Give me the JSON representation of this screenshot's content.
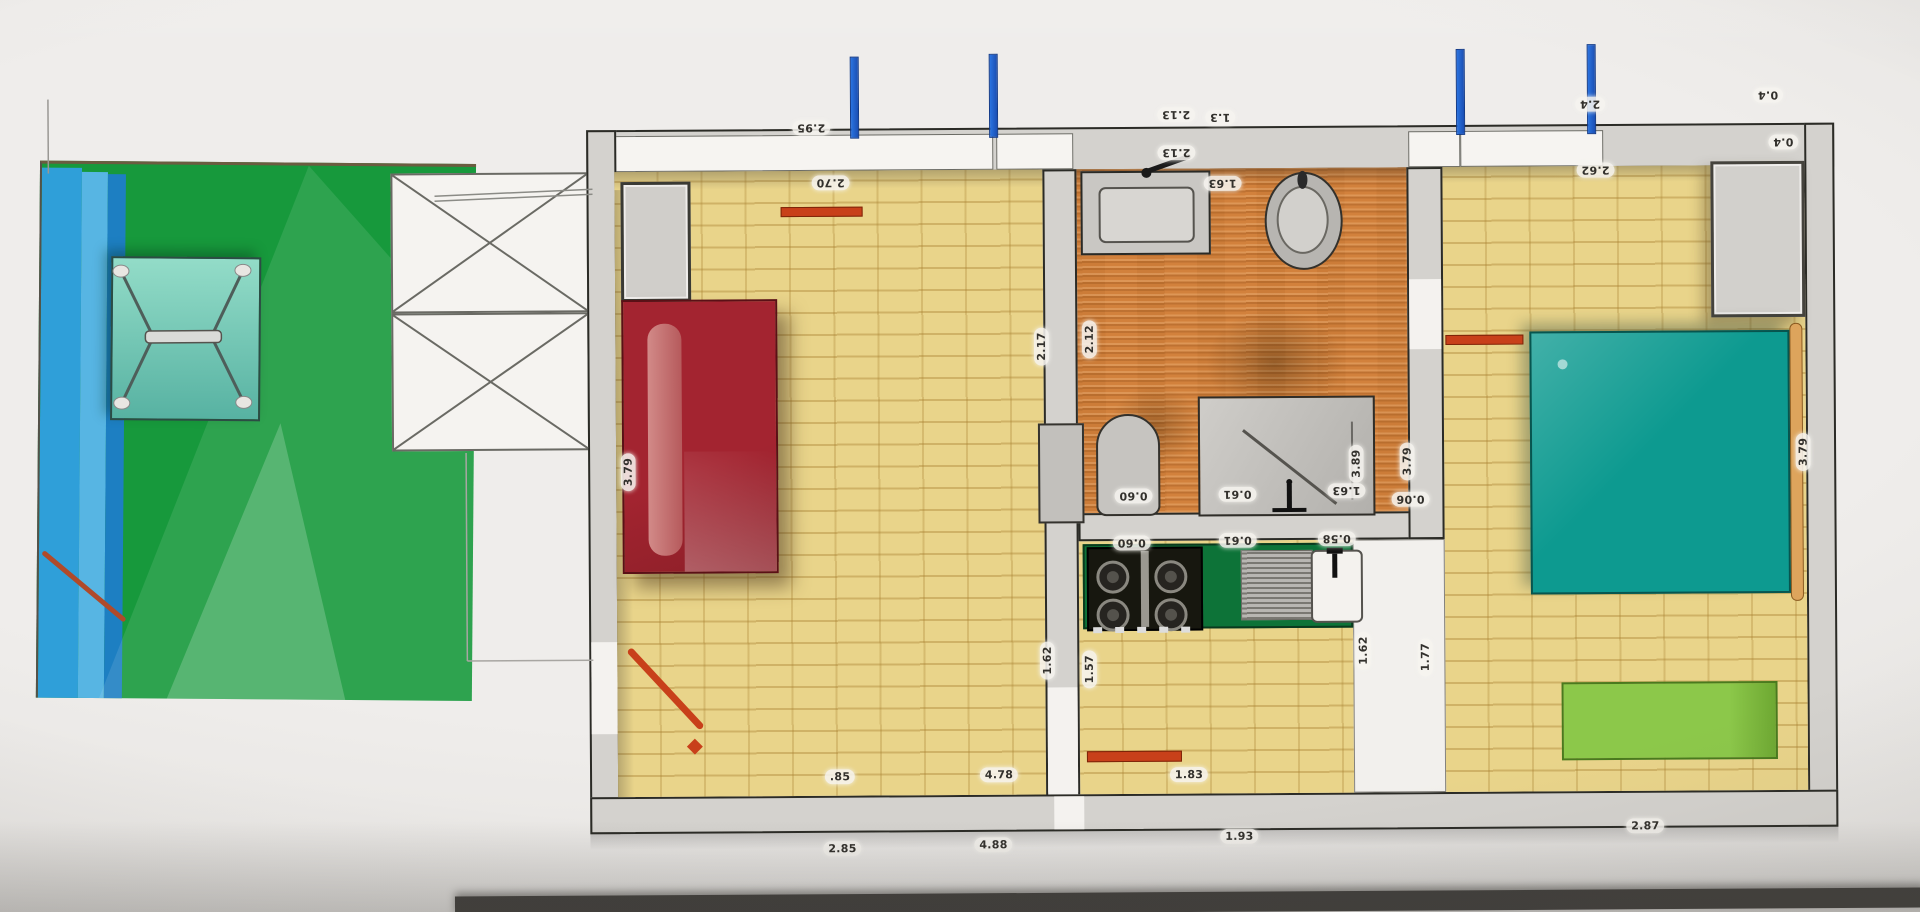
{
  "plan": {
    "dim_labels": [
      {
        "text": "2.95",
        "x": 813,
        "y": 127,
        "o": "flip"
      },
      {
        "text": "2.13",
        "x": 1178,
        "y": 116,
        "o": "flip"
      },
      {
        "text": "1.3",
        "x": 1222,
        "y": 119,
        "o": "flip"
      },
      {
        "text": "2.4",
        "x": 1592,
        "y": 108,
        "o": "flip"
      },
      {
        "text": "0.4",
        "x": 1770,
        "y": 100,
        "o": "flip"
      },
      {
        "text": "2.70",
        "x": 832,
        "y": 182,
        "o": "flip"
      },
      {
        "text": "2.13",
        "x": 1178,
        "y": 154,
        "o": "flip"
      },
      {
        "text": "1.63",
        "x": 1224,
        "y": 185,
        "o": "flip"
      },
      {
        "text": "2.62",
        "x": 1597,
        "y": 174,
        "o": "flip"
      },
      {
        "text": "0.4",
        "x": 1785,
        "y": 147,
        "o": "flip"
      },
      {
        "text": "3.79",
        "x": 628,
        "y": 470,
        "o": "vert"
      },
      {
        "text": "2.17",
        "x": 1042,
        "y": 347,
        "o": "vert"
      },
      {
        "text": "2.12",
        "x": 1090,
        "y": 340,
        "o": "vert"
      },
      {
        "text": "0.60",
        "x": 1133,
        "y": 497,
        "o": "flip"
      },
      {
        "text": "0.61",
        "x": 1237,
        "y": 496,
        "o": "flip"
      },
      {
        "text": "1.63",
        "x": 1346,
        "y": 493,
        "o": "flip"
      },
      {
        "text": "3.89",
        "x": 1356,
        "y": 466,
        "o": "vert"
      },
      {
        "text": "3.79",
        "x": 1407,
        "y": 464,
        "o": "vert"
      },
      {
        "text": "0.06",
        "x": 1410,
        "y": 502,
        "o": "flip"
      },
      {
        "text": "0.60",
        "x": 1131,
        "y": 544,
        "o": "flip"
      },
      {
        "text": "0.61",
        "x": 1237,
        "y": 542,
        "o": "flip"
      },
      {
        "text": "0.58",
        "x": 1336,
        "y": 541,
        "o": "flip"
      },
      {
        "text": "1.62",
        "x": 1046,
        "y": 661,
        "o": "vert"
      },
      {
        "text": "1.57",
        "x": 1088,
        "y": 670,
        "o": "vert"
      },
      {
        "text": "1.62",
        "x": 1362,
        "y": 653,
        "o": "vert"
      },
      {
        "text": "1.77",
        "x": 1424,
        "y": 660,
        "o": "vert"
      },
      {
        "text": "3.79",
        "x": 1803,
        "y": 457,
        "o": "vert"
      },
      {
        "text": ".85",
        "x": 838,
        "y": 776,
        "o": "up"
      },
      {
        "text": "4.78",
        "x": 997,
        "y": 775,
        "o": "up"
      },
      {
        "text": "1.83",
        "x": 1187,
        "y": 776,
        "o": "up"
      },
      {
        "text": "2.85",
        "x": 840,
        "y": 848,
        "o": "up"
      },
      {
        "text": "4.88",
        "x": 991,
        "y": 845,
        "o": "up"
      },
      {
        "text": "1.93",
        "x": 1237,
        "y": 838,
        "o": "up"
      },
      {
        "text": "2.87",
        "x": 1643,
        "y": 830,
        "o": "up"
      }
    ],
    "elements": [
      "garden-lawn",
      "pool-water-stripes",
      "garden-table",
      "porch-stairs",
      "living-room",
      "cabinet",
      "sofa",
      "bathroom",
      "wash-basin",
      "toilet",
      "shower-cabin",
      "kitchen",
      "stove",
      "drainboard",
      "kitchen-sink",
      "hallway",
      "bedroom",
      "bed",
      "wardrobe",
      "bench",
      "window-markers",
      "door-markers"
    ],
    "colors": {
      "lawn_green": "#17993c",
      "water_blue": "#2f9fd9",
      "table_teal": "#7fd0bd",
      "floor_parquet": "#e9d48a",
      "bath_floor": "#d2813c",
      "wall_gray": "#d4d2ce",
      "sofa_red": "#a02530",
      "bed_teal": "#0d9a90",
      "bench_green": "#85c043",
      "counter_green": "#0d7338",
      "window_marker_blue": "#1e62d0",
      "door_marker_red": "#c8401a",
      "label_text": "#32302c"
    }
  }
}
